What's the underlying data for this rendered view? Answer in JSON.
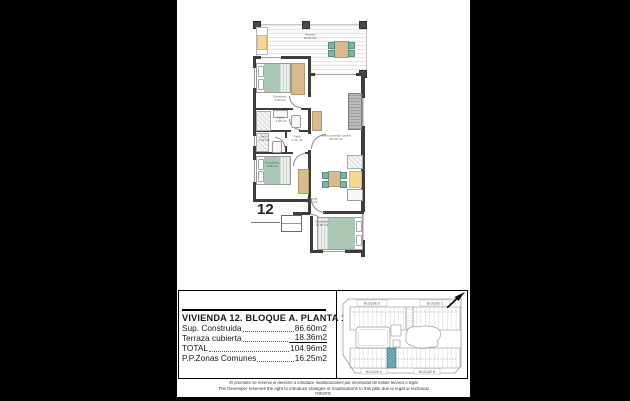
{
  "floor_plan": {
    "unit_number": "12",
    "labels": {
      "terraza": {
        "name": "Terraza",
        "area": "18.36 m2"
      },
      "dormitorio_1": {
        "name": "Dormitorio",
        "area": "9.80 m2"
      },
      "bano_1": {
        "name": "Baño",
        "area": "3.65 m2"
      },
      "bano_2": {
        "name": "Baño",
        "area": "2.30 m2"
      },
      "paso": {
        "name": "Paso",
        "area": "1.32 m2"
      },
      "salon": {
        "name": "Salón comedor cocina",
        "area": "30.05 m2"
      },
      "dormitorio_2": {
        "name": "Dormitorio",
        "area": "8.05 m2"
      },
      "dormitorio_3": {
        "name": "Dormitorio",
        "area": "10.05 m2"
      },
      "entrada": {
        "name": "Entrada",
        "area": "2.02 m2"
      }
    }
  },
  "info_panel": {
    "title": "VIVIENDA 12. BLOQUE A. PLANTA 1ª",
    "rows": [
      {
        "label": "Sup. Construida",
        "value": "86.60m2"
      },
      {
        "label": "Terraza cubierta",
        "value": "18.36m2"
      },
      {
        "label": "TOTAL",
        "value": "104.96m2"
      },
      {
        "label": "P.P.Zonas Comunes",
        "value": "16.25m2"
      }
    ]
  },
  "site_map": {
    "block_top_left": "BLOQUE D",
    "block_top_right": "BLOQUE C",
    "block_bottom_left": "BLOQUE A",
    "block_bottom_right": "BLOQUE B"
  },
  "footer": {
    "line_es": "El promotor se reserva el derecho a introducir modificaciones por necesidad de índole técnica o legal",
    "line_en": "The Developer reserves the right to introduce changes or modifications to this plan due to legal or technical reasons."
  },
  "colors": {
    "highlight": "#7fb3bd",
    "bed": "#abc7b6",
    "chair": "#7fb3a3",
    "wood": "#d8ba8e",
    "yellow": "#f3d795",
    "wall": "#3d3d3d"
  }
}
